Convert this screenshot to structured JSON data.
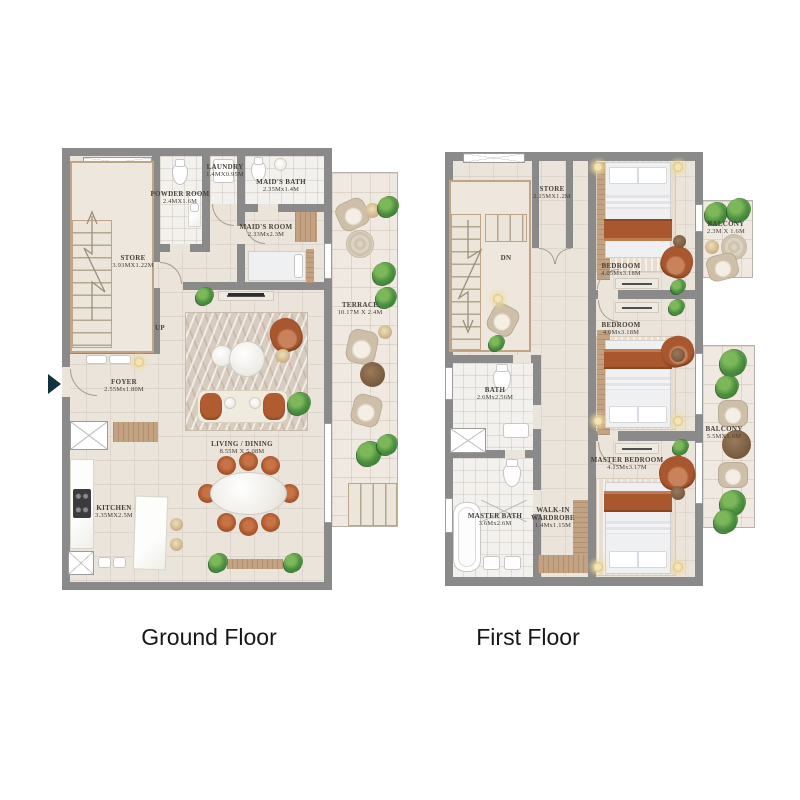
{
  "colors": {
    "background": "#ffffff",
    "wall": "#8a8a8a",
    "floor": "#ebe4db",
    "outdoor_floor": "#efe9e2",
    "wood": "#c3a281",
    "terracotta_accent": "#a8572e",
    "plant_green": "#4c9140",
    "label_text": "#45413a",
    "title_text": "#15171b"
  },
  "floors": [
    {
      "title": "Ground Floor",
      "stairs_label": "UP",
      "rooms": {
        "store": {
          "name": "STORE",
          "dims": "3.93MX1.22M"
        },
        "powder_room": {
          "name": "POWDER ROOM",
          "dims": "2.4MX1.6M"
        },
        "laundry": {
          "name": "LAUNDRY",
          "dims": "1.4MX0.95M"
        },
        "maids_bath": {
          "name": "MAID'S BATH",
          "dims": "2.35Mx1.4M"
        },
        "maids_room": {
          "name": "MAID'S ROOM",
          "dims": "2.33Mx2.3M"
        },
        "foyer": {
          "name": "FOYER",
          "dims": "2.55Mx1.80M"
        },
        "living_dining": {
          "name": "LIVING / DINING",
          "dims": "8.55M X 5.08M"
        },
        "kitchen": {
          "name": "KITCHEN",
          "dims": "3.35MX2.5M"
        },
        "terrace": {
          "name": "TERRACE",
          "dims": "10.17M X 2.4M"
        }
      }
    },
    {
      "title": "First Floor",
      "stairs_label": "DN",
      "rooms": {
        "store": {
          "name": "STORE",
          "dims": "2.15MX1.2M"
        },
        "bedroom_1": {
          "name": "BEDROOM",
          "dims": "4.05Mx3.18M"
        },
        "balcony_1": {
          "name": "BALCONY",
          "dims": "2.3M X 1.6M"
        },
        "bedroom_2": {
          "name": "BEDROOM",
          "dims": "4.0Mx3.18M"
        },
        "bath": {
          "name": "BATH",
          "dims": "2.6Mx2.56M"
        },
        "master_bedroom": {
          "name": "MASTER BEDROOM",
          "dims": "4.15Mx3.17M"
        },
        "balcony_2": {
          "name": "BALCONY",
          "dims": "5.5MX1.6M"
        },
        "master_bath": {
          "name": "MASTER BATH",
          "dims": "3.6Mx2.6M"
        },
        "walk_in_wardrobe": {
          "name": "WALK-IN WARDROBE",
          "dims": "1.4Mx1.15M"
        }
      }
    }
  ]
}
